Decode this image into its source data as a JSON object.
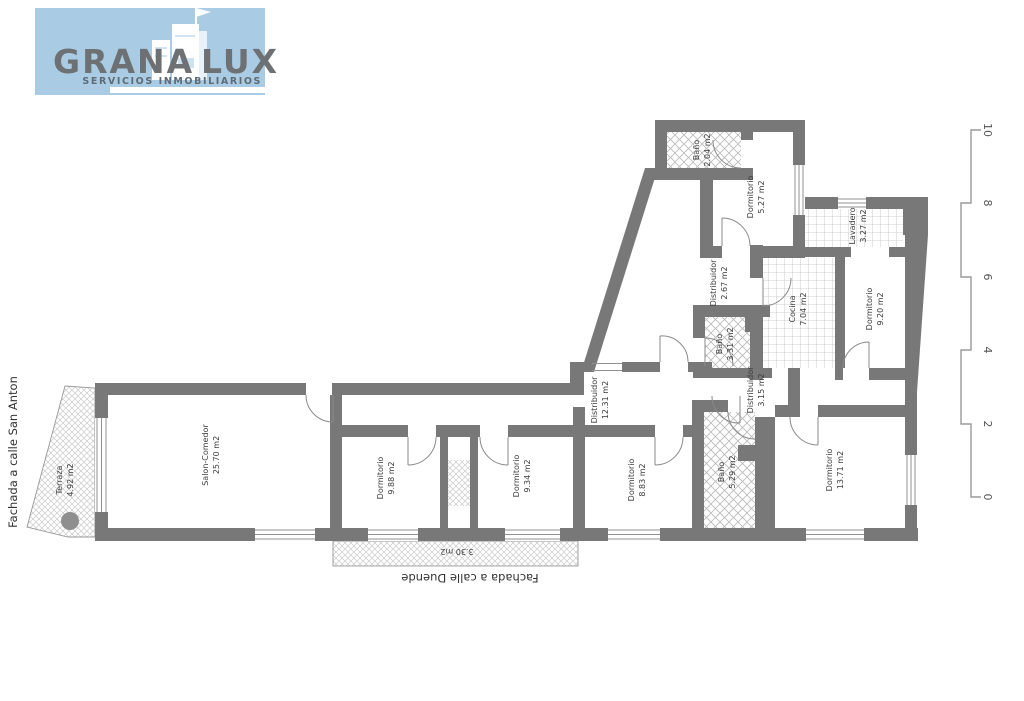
{
  "brand": {
    "line1": "GRANA",
    "line2": "LUX",
    "tagline": "SERVICIOS INMOBILIARIOS",
    "bg_color": "#a9cbe4",
    "text_color": "#6d7174"
  },
  "facades": {
    "left": "Fachada a calle San Anton",
    "bottom": "Fachada a calle Duende"
  },
  "scale": {
    "ticks": [
      "0",
      "2",
      "4",
      "6",
      "8",
      "10"
    ]
  },
  "plan": {
    "wall_color": "#787878",
    "rooms": [
      {
        "name": "Terraza",
        "area": "4.92 m2"
      },
      {
        "name": "Salon-Comedor",
        "area": "25.70 m2"
      },
      {
        "name": "Dormitorio",
        "area": "9.88 m2"
      },
      {
        "name": "Dormitorio",
        "area": "9.34 m2"
      },
      {
        "name": "Dormitorio",
        "area": "8.83 m2"
      },
      {
        "name": "Baño",
        "area": "5.29 m2"
      },
      {
        "name": "Dormitorio",
        "area": "13.71 m2"
      },
      {
        "name": "Distribuidor",
        "area": "12.31 m2"
      },
      {
        "name": "Distribuidor",
        "area": "3.15 m2"
      },
      {
        "name": "Baño",
        "area": "3.31 m2"
      },
      {
        "name": "Cocina",
        "area": "7.04 m2"
      },
      {
        "name": "Dormitorio",
        "area": "9.20 m2"
      },
      {
        "name": "Lavadero",
        "area": "3.27 m2"
      },
      {
        "name": "Distribuidor",
        "area": "2.67 m2"
      },
      {
        "name": "Dormitorio",
        "area": "5.27 m2"
      },
      {
        "name": "Baño",
        "area": "2.04 m2"
      },
      {
        "name": "",
        "area": "3.30 m2"
      }
    ]
  }
}
